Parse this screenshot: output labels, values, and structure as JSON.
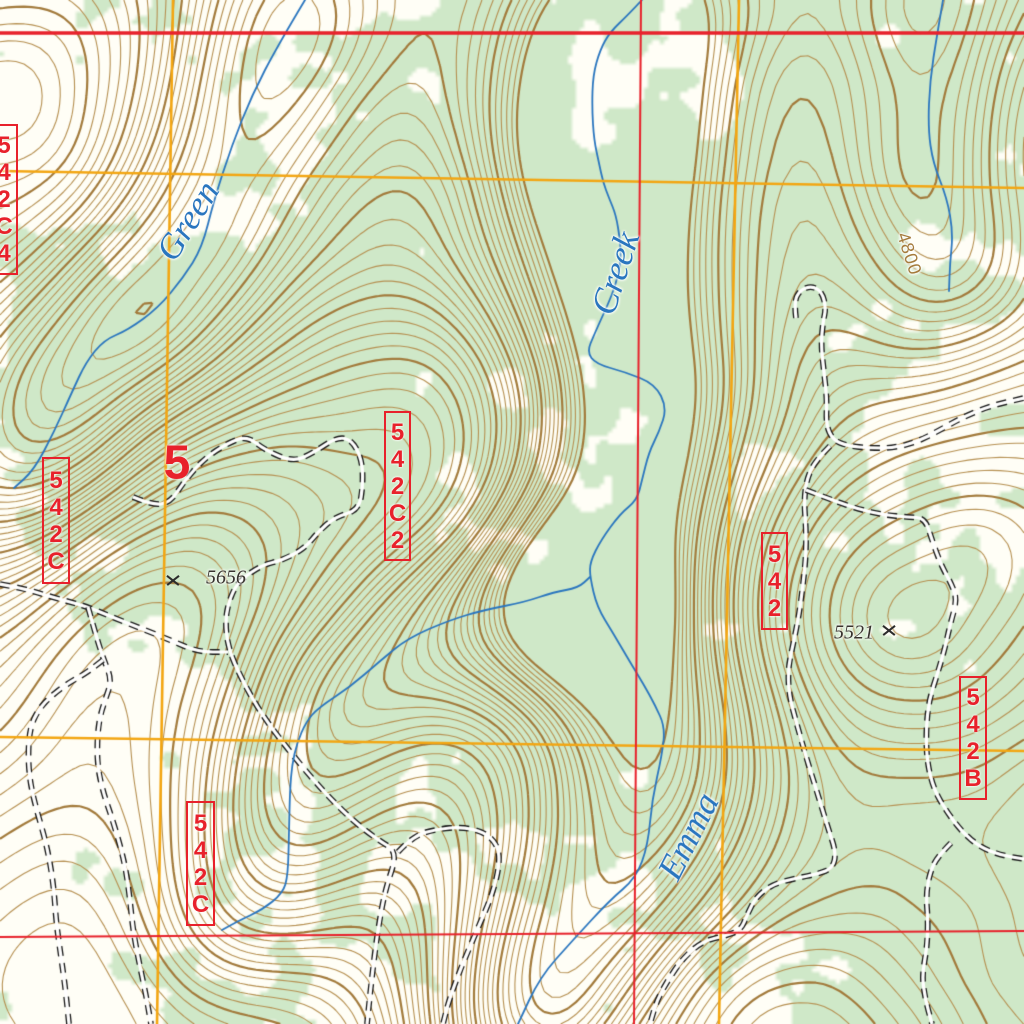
{
  "streams": [
    {
      "name": "Green"
    },
    {
      "name": "Creek"
    },
    {
      "name": "Emma"
    }
  ],
  "section_number": "5",
  "spot_elevations": [
    {
      "value": "5656"
    },
    {
      "value": "5521"
    }
  ],
  "contour_elevation_label": "4800",
  "route_labels": [
    "542C4",
    "542C",
    "542C2",
    "542",
    "542C",
    "542B"
  ],
  "colors": {
    "background": "#fffef6",
    "forest_green": "#cfe8c8",
    "contour_brown": "#b69051",
    "contour_index_brown": "#a37b3c",
    "grid_red": "#e8212b",
    "grid_yellow": "#f3a612",
    "stream_blue": "#2a76bf",
    "road_black": "#161616",
    "road_casing_white": "#ffffff"
  }
}
